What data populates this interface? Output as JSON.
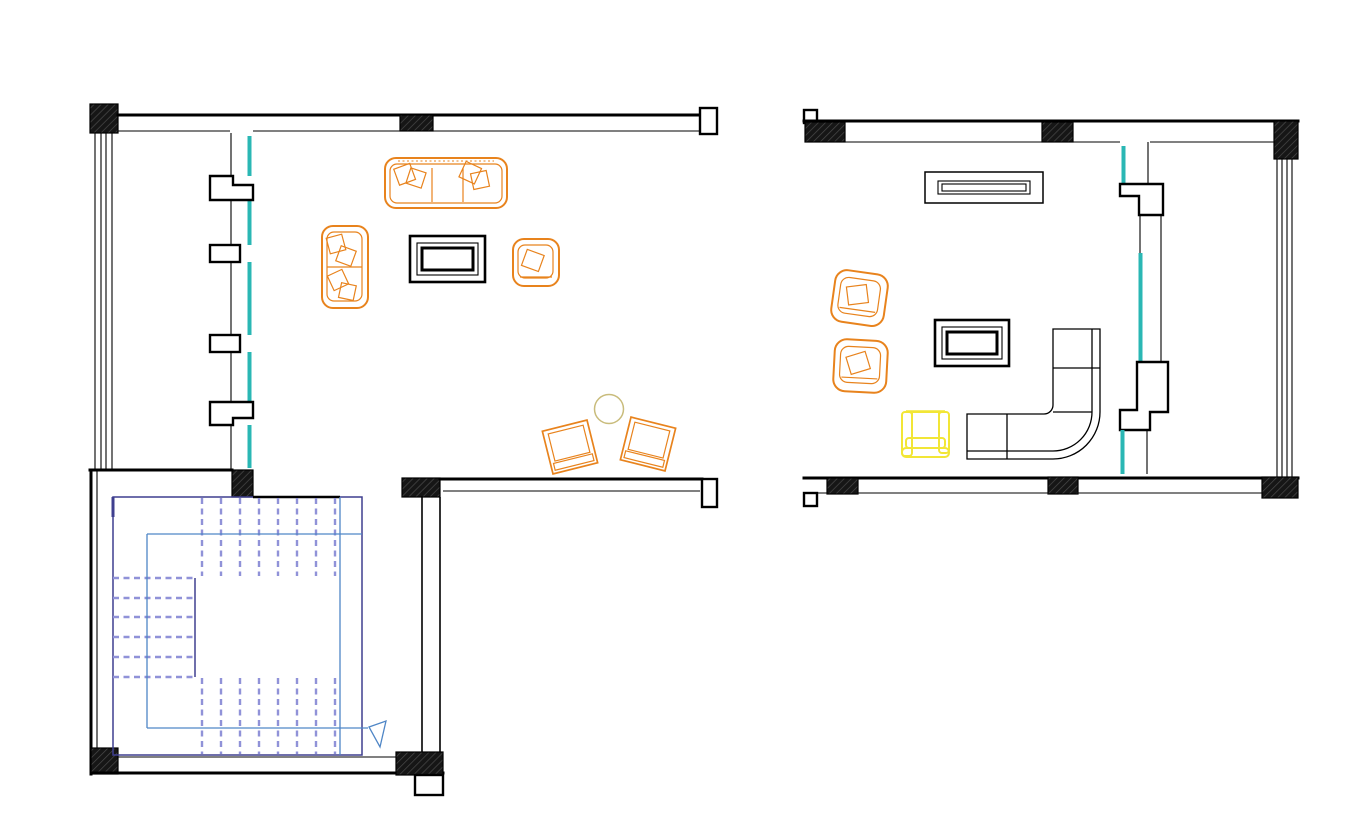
{
  "document": {
    "kind": "architectural-floor-plan",
    "views": 2
  },
  "colors": {
    "background": "#ffffff",
    "wall_line": "#000000",
    "hatch_fill": "#161616",
    "hatch_stroke": "#4a4a4a",
    "glazing": "#2ab7b4",
    "furniture_orange": "#e8831d",
    "furniture_yellow": "#f2e636",
    "circle_accent": "#c9bc7c",
    "stair_outline": "#3f3f8f",
    "stair_tread": "#9092d8",
    "stair_walkline": "#4f86c6"
  },
  "plans": [
    {
      "id": "lower-level",
      "features": [
        "hatched-column-blocks",
        "west-curtain-wall-4-lines",
        "window-wall-teal-glazing-with-mullions",
        "u-shaped-stair-with-direction-arrow"
      ],
      "furniture": [
        "three-seat-sofa",
        "two-seat-loveseat",
        "armchair",
        "coffee-table",
        "angled-chair-left",
        "angled-chair-right",
        "round-side-table"
      ]
    },
    {
      "id": "upper-level",
      "features": [
        "hatched-column-blocks",
        "east-curtain-wall-4-lines",
        "interior-wall-teal-glazing-with-jogs"
      ],
      "furniture": [
        "media-console",
        "armchair-upper",
        "armchair-lower",
        "yellow-armchair",
        "coffee-table",
        "l-shaped-corner-sofa"
      ]
    }
  ]
}
